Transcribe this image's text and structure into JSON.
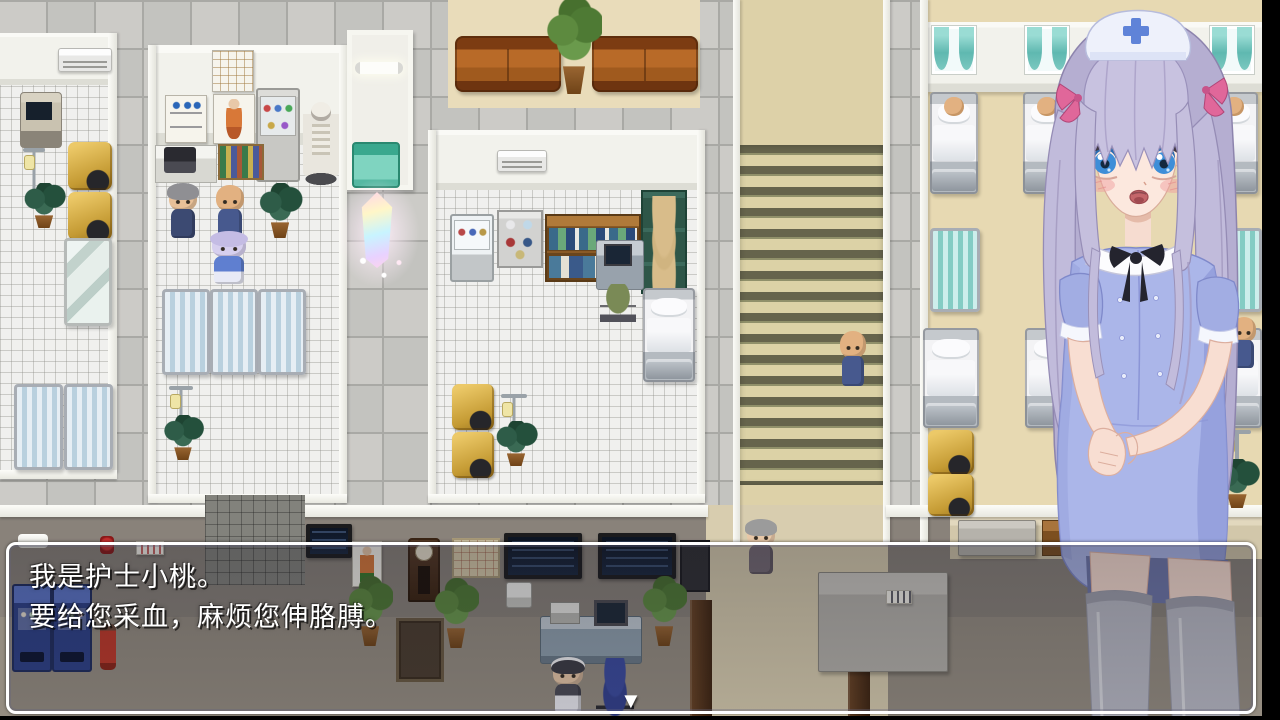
{
  "stage": {
    "width": 1280,
    "height": 720
  },
  "dialog": {
    "line1": "我是护士小桃。",
    "line2": "要给您采血，麻烦您伸胳膊。",
    "continue_glyph": "▼"
  },
  "colors": {
    "dialog_border": "#ffffff",
    "dialog_backdrop": "rgba(25,25,35,0.32)",
    "stairs_step": "#66644c",
    "nurse_dress": "#abb6e9",
    "nurse_hair": "#c3bddb",
    "curtain_teal": "#5fb8b0",
    "crystal_glow": "#ffe4f6"
  }
}
